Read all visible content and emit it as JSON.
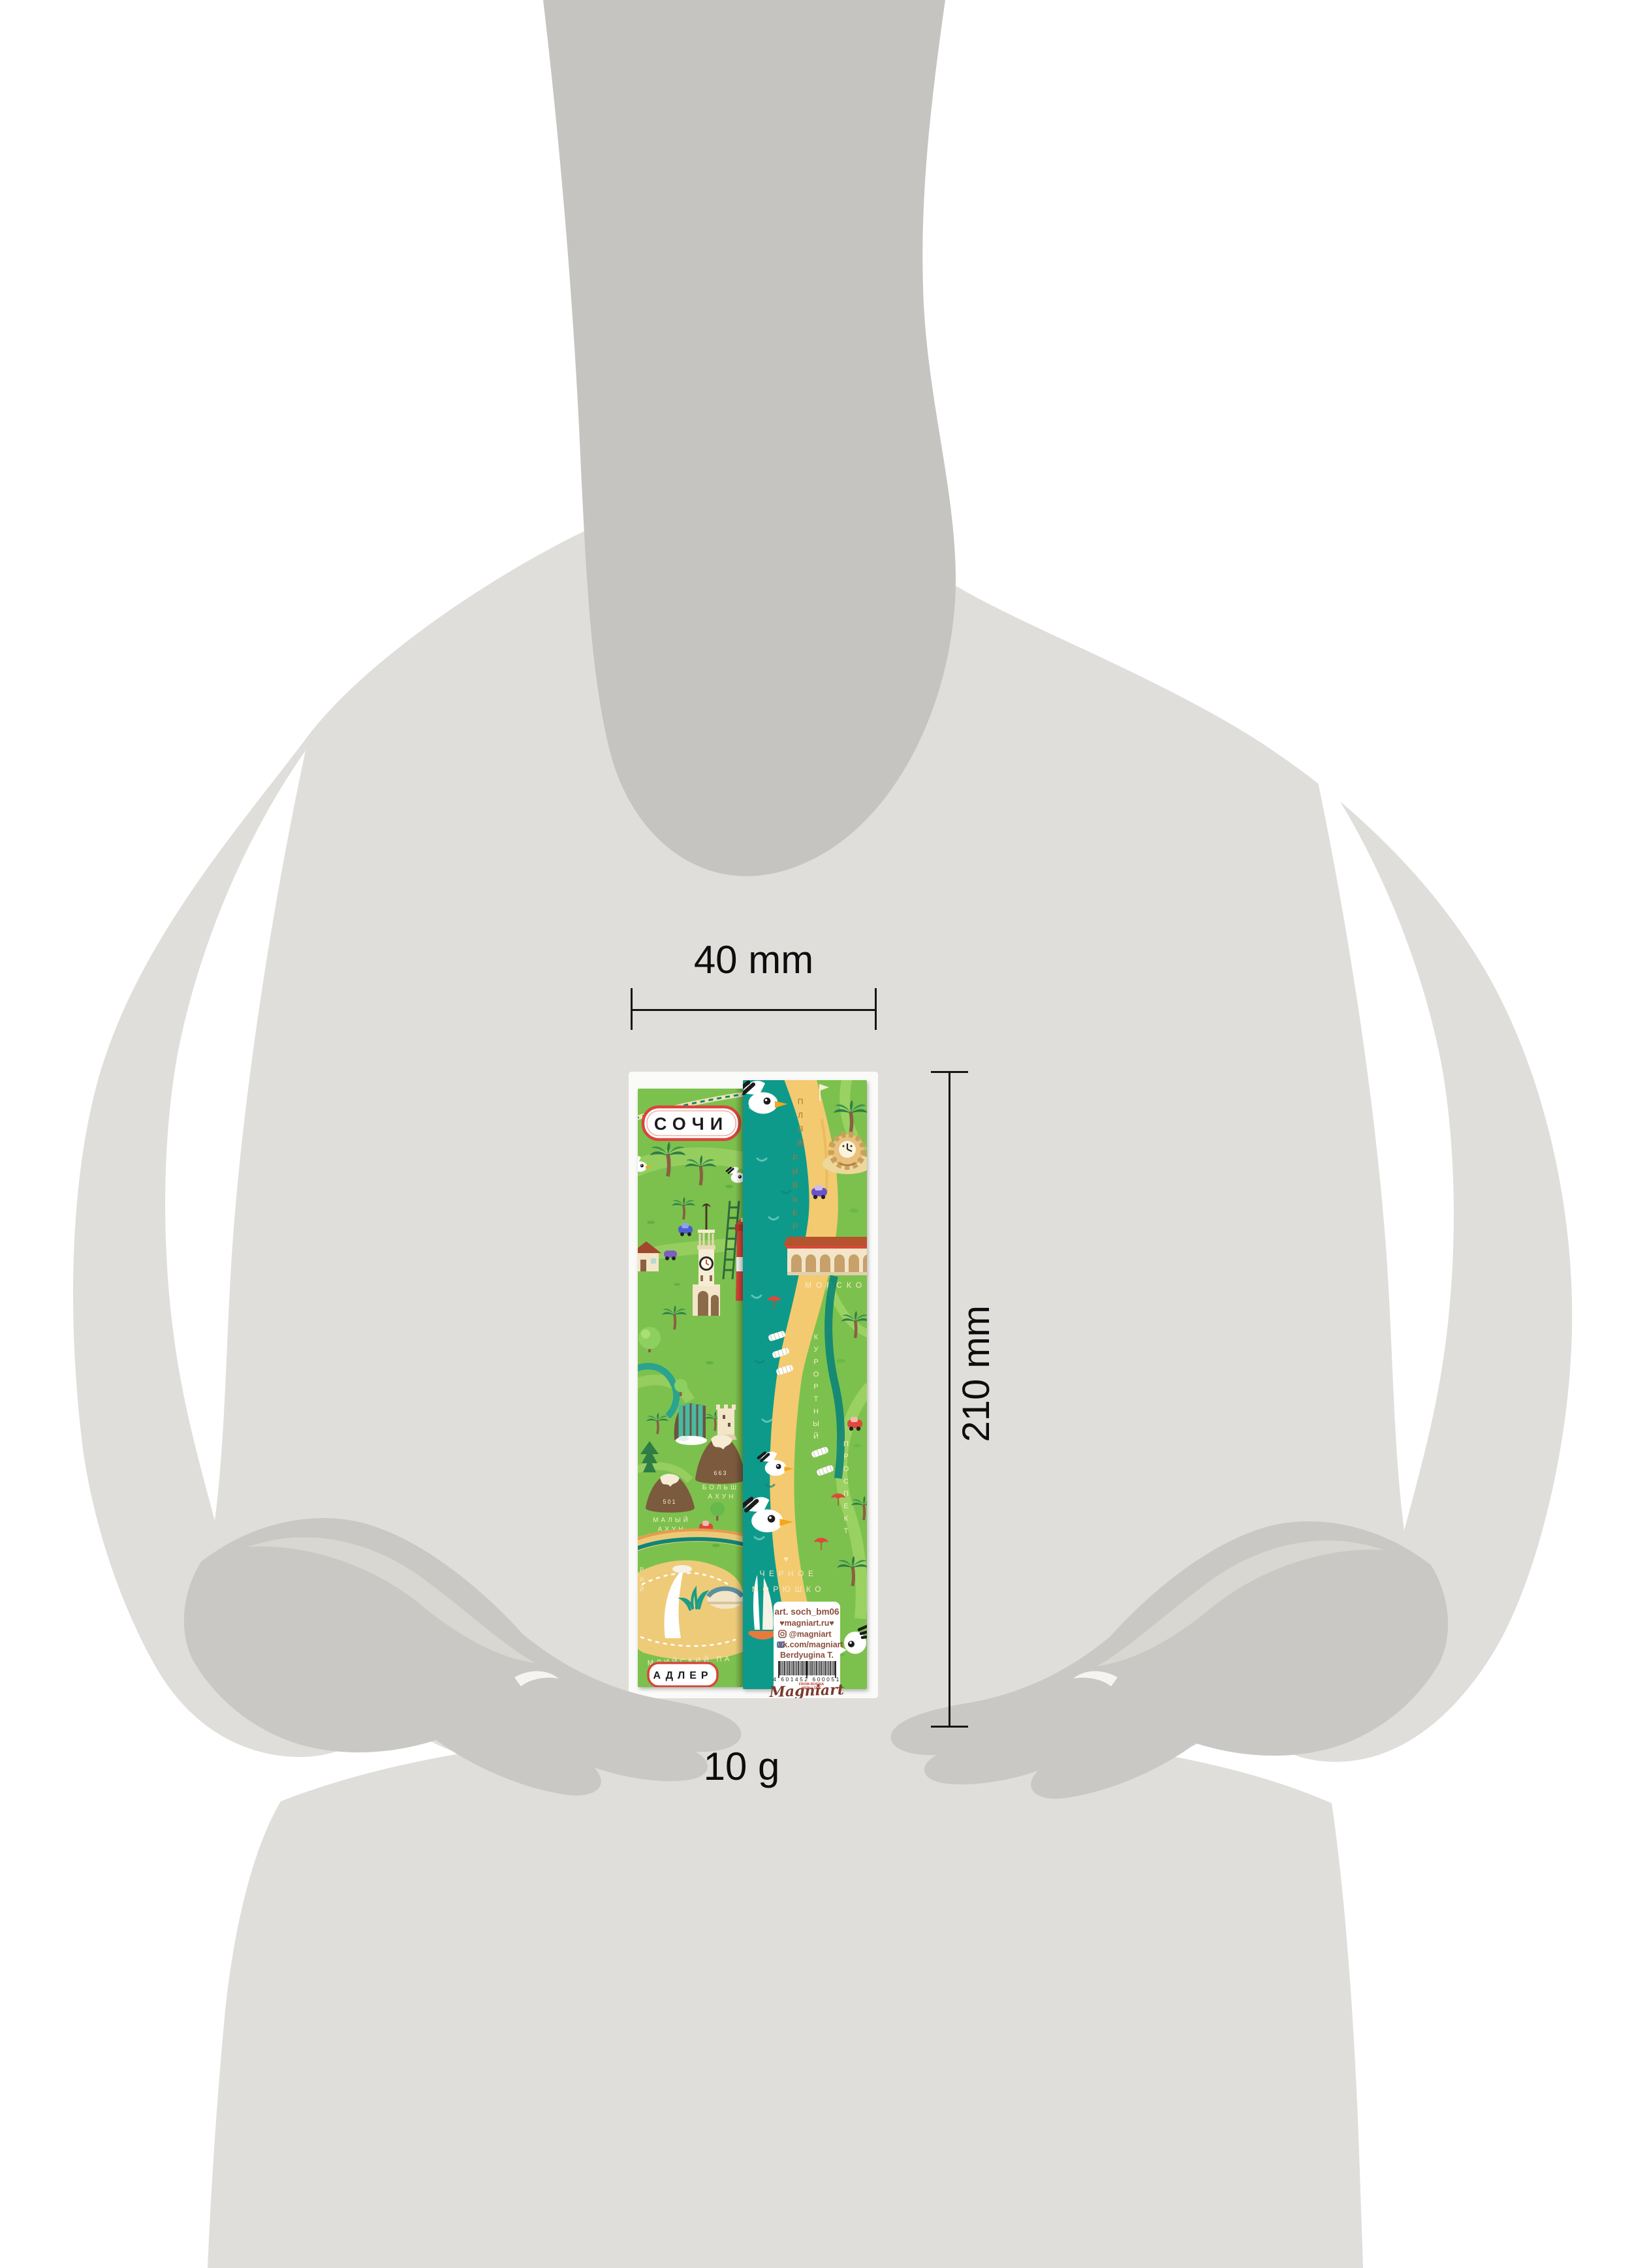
{
  "annotations": {
    "width": "40 mm",
    "height": "210 mm",
    "weight": "10 g"
  },
  "front": {
    "city": "СОЧИ",
    "badge_bottom": "АДЛЕР",
    "elevation_big": "663",
    "elevation_small": "501",
    "big_ahun": [
      "БОЛЬШ",
      "АХУН"
    ],
    "small_ahun": [
      "МАЛЫЙ",
      "АХУН"
    ],
    "olympic_park": "МЛИЙСКИЙ ПА",
    "street_partial": "РИЙ"
  },
  "back": {
    "beach_1": "ПЛЯЖ",
    "beach_2": "РИВЬЕРА",
    "marine": "МОРСКО",
    "street_1": "КУРОРТНЫЙ",
    "street_2": "ПРОСПЕКТ",
    "sea_name_1": "ЧЕРНОЕ",
    "sea_name_2": "МОРЮШКО",
    "label": {
      "art": "art. soch_bm06",
      "site": "♥magniart.ru♥",
      "instagram": "@magniart",
      "vk": "vk.com/magniart",
      "author": "Berdyugina T.",
      "barcode": "4 601452 600051",
      "tagline_1": "FROM RUSSIA",
      "tagline_2": "WITH LOVE",
      "brand": "Magniart"
    }
  },
  "colors": {
    "torso": "#dfdedb",
    "neck": "#c5c4c0",
    "hands": "#c9c8c4",
    "green": "#7cc14e",
    "sea": "#109a8b",
    "sand": "#f3ca70",
    "accent_red": "#dd4a3b"
  }
}
